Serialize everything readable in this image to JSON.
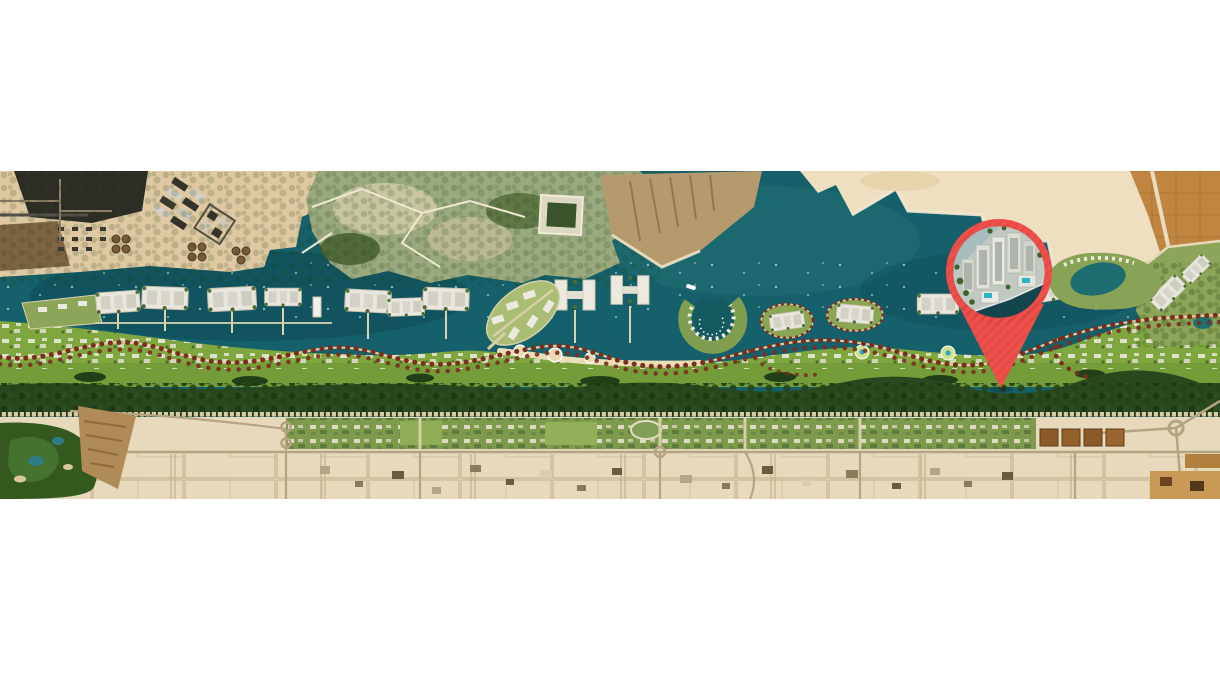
{
  "page": {
    "background_color": "#ffffff"
  },
  "map": {
    "kind": "masterplan-satellite-map",
    "alt": "Aerial masterplan map of a coastal waterfront development strip between the sea and the desert, with a red location pin over a residential project",
    "colors": {
      "water": "#15606A",
      "water_deep": "#0D4751",
      "water_light": "#2B7C7A",
      "sand": "#DFC9A2",
      "sand_light": "#EDDFC0",
      "desert": "#E6D9BC",
      "industrial_dark": "#2E2C26",
      "earth_brown": "#6E5231",
      "island_green": "#9AA97E",
      "island_pale": "#CDC9A4",
      "lawn_green": "#7FA63F",
      "tree_dark": "#2A481E",
      "community_green": "#7E9B4D",
      "farm_orange": "#C08540",
      "plot_line": "#C3B190",
      "road_grey": "#B5A482",
      "path_tan": "#E3D6AE",
      "tree_maroon": "#7A2F1E",
      "building_white": "#ECEADF",
      "golf_green": "#33591F",
      "pool_teal": "#2FB4C4",
      "canal_dark": "#14454E"
    },
    "marker": {
      "name": "location-pin",
      "pin_color": "#F1504A",
      "pin_stripe_color": "#D8403C",
      "photo_alt": "aerial rendering of waterfront residential towers with pools and a canal"
    }
  }
}
